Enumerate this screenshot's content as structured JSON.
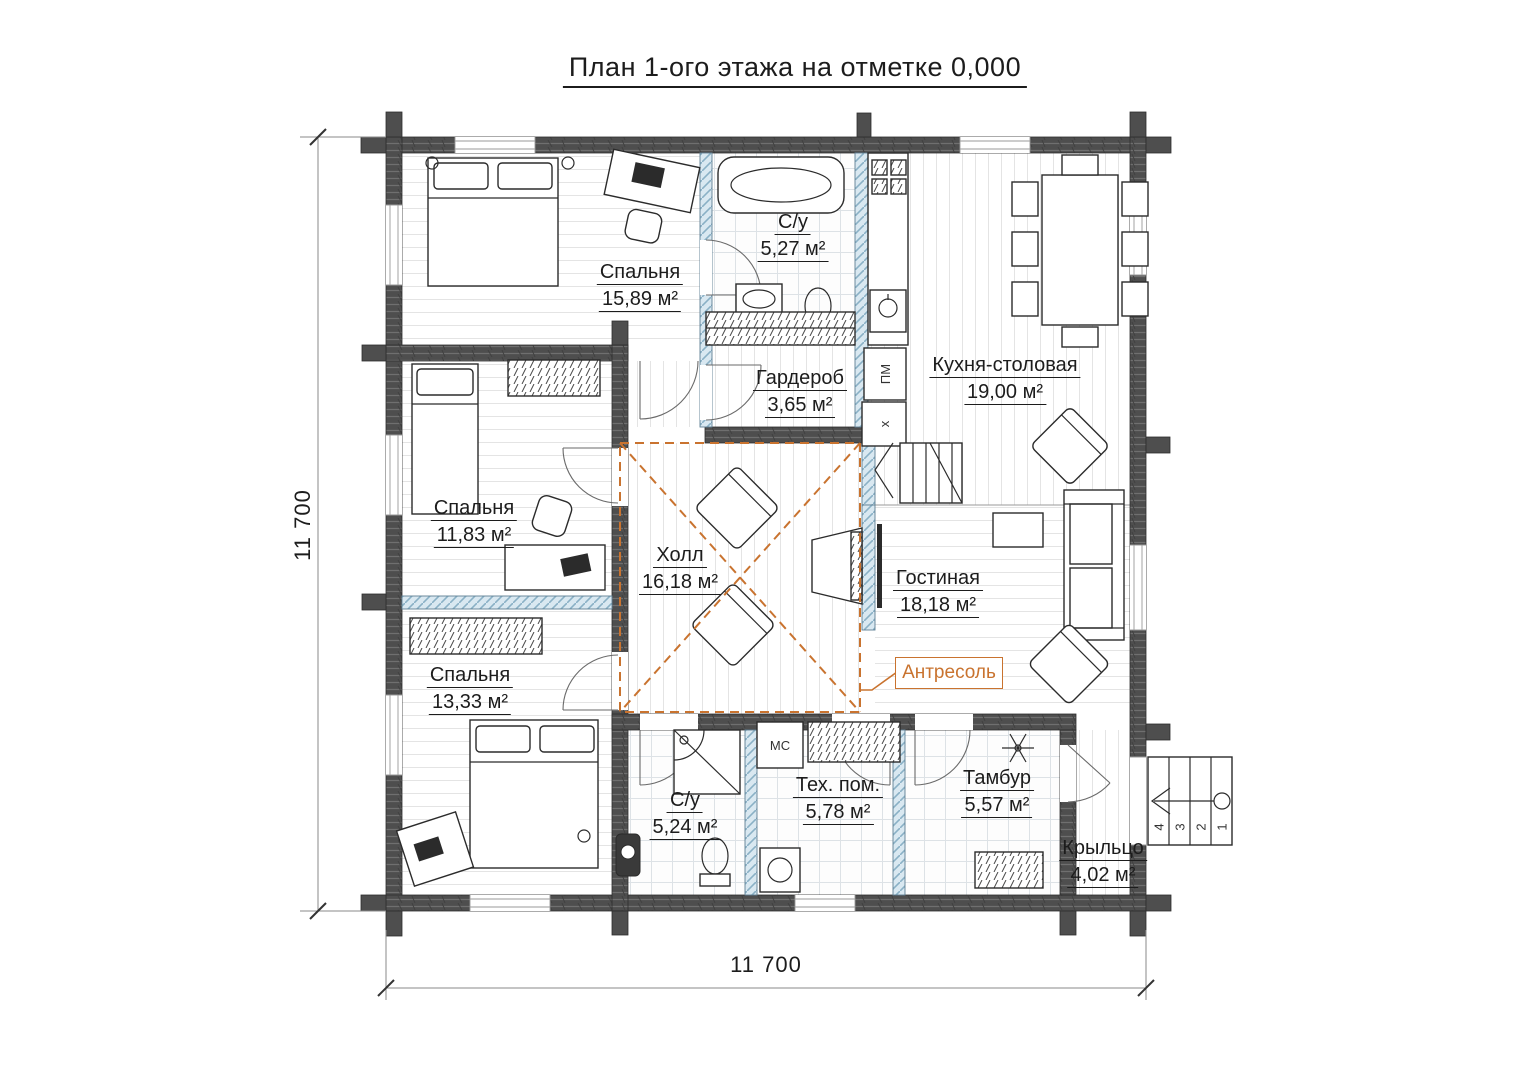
{
  "title": "План 1-ого этажа на отметке 0,000",
  "dimensions": {
    "left": "11 700",
    "bottom": "11 700"
  },
  "callout": {
    "label": "Антресоль"
  },
  "rooms": [
    {
      "name": "Спальня",
      "area": "15,89 м²"
    },
    {
      "name": "С/у",
      "area": "5,27 м²"
    },
    {
      "name": "Кухня-столовая",
      "area": "19,00 м²"
    },
    {
      "name": "Гардероб",
      "area": "3,65 м²"
    },
    {
      "name": "Спальня",
      "area": "11,83 м²"
    },
    {
      "name": "Холл",
      "area": "16,18 м²"
    },
    {
      "name": "Гостиная",
      "area": "18,18 м²"
    },
    {
      "name": "Спальня",
      "area": "13,33 м²"
    },
    {
      "name": "С/у",
      "area": "5,24 м²"
    },
    {
      "name": "Тех. пом.",
      "area": "5,78 м²"
    },
    {
      "name": "Тамбур",
      "area": "5,57 м²"
    },
    {
      "name": "Крыльцо",
      "area": "4,02 м²"
    }
  ],
  "appliances": {
    "dishwasher": "ПМ",
    "fridge": "х",
    "washing_machine": "МС"
  },
  "porch_steps": [
    "4",
    "3",
    "2",
    "1"
  ],
  "colors": {
    "accent": "#c9732f",
    "wall": "#4d4d4d",
    "partition": "#d9e8f1",
    "line": "#1c1c1c"
  }
}
